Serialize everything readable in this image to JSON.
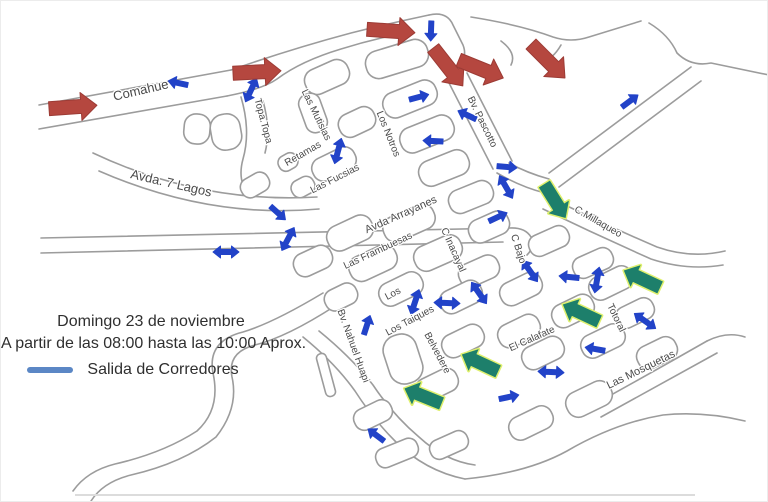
{
  "legend": {
    "date_line": "Domingo 23 de noviembre",
    "time_line": "A partir de las 08:00 hasta las 10:00 Aprox.",
    "start_label": "Salida de Corredores",
    "swatch_color": "#5b87c5"
  },
  "colors": {
    "background": "#ffffff",
    "road": "#9c9c9c",
    "street_label": "#4a4a4a",
    "route_arrow_blue": "#2243c8",
    "entry_arrow_red": "#b5473f",
    "entry_arrow_red_edge": "#9c3b35",
    "start_arrow_green": "#1d7f6b",
    "start_arrow_outline": "#dff06e"
  },
  "streets": [
    {
      "name": "Comahue",
      "x": 140,
      "y": 90,
      "rot": -13,
      "fs": 13
    },
    {
      "name": "Avda. 7 Lagos",
      "x": 170,
      "y": 183,
      "rot": 13,
      "fs": 13
    },
    {
      "name": "Topa.Topa",
      "x": 262,
      "y": 120,
      "rot": 75,
      "fs": 10
    },
    {
      "name": "Las Mutisias",
      "x": 315,
      "y": 114,
      "rot": 64,
      "fs": 10
    },
    {
      "name": "Retamas",
      "x": 302,
      "y": 153,
      "rot": -30,
      "fs": 10
    },
    {
      "name": "Las Fucsias",
      "x": 334,
      "y": 178,
      "rot": -27,
      "fs": 10
    },
    {
      "name": "Los Notros",
      "x": 387,
      "y": 133,
      "rot": 68,
      "fs": 10
    },
    {
      "name": "Bv. Pascotto",
      "x": 481,
      "y": 121,
      "rot": 64,
      "fs": 10
    },
    {
      "name": "Avda Arrayanes",
      "x": 400,
      "y": 214,
      "rot": -24,
      "fs": 11
    },
    {
      "name": "Las Frambuesas",
      "x": 377,
      "y": 250,
      "rot": -25,
      "fs": 10
    },
    {
      "name": "C Inacayal",
      "x": 452,
      "y": 249,
      "rot": 66,
      "fs": 10
    },
    {
      "name": "C Bajo",
      "x": 517,
      "y": 248,
      "rot": 72,
      "fs": 10
    },
    {
      "name": "C.Millaqueo",
      "x": 597,
      "y": 221,
      "rot": 30,
      "fs": 10
    },
    {
      "name": "Los",
      "x": 392,
      "y": 293,
      "rot": -28,
      "fs": 10
    },
    {
      "name": "Los Taiques",
      "x": 409,
      "y": 320,
      "rot": -28,
      "fs": 10
    },
    {
      "name": "Belvedere",
      "x": 436,
      "y": 352,
      "rot": 62,
      "fs": 10
    },
    {
      "name": "El Calafate",
      "x": 531,
      "y": 338,
      "rot": -24,
      "fs": 10
    },
    {
      "name": "Totoral",
      "x": 615,
      "y": 317,
      "rot": 64,
      "fs": 10
    },
    {
      "name": "Las Mosquetas",
      "x": 640,
      "y": 369,
      "rot": -26,
      "fs": 11
    },
    {
      "name": "Bv. Nahuel Huapi",
      "x": 352,
      "y": 345,
      "rot": 70,
      "fs": 10
    }
  ],
  "arrows": {
    "red": [
      {
        "x": 72,
        "y": 106,
        "rot": -4
      },
      {
        "x": 256,
        "y": 71,
        "rot": -3
      },
      {
        "x": 390,
        "y": 30,
        "rot": 4
      },
      {
        "x": 447,
        "y": 66,
        "rot": 52
      },
      {
        "x": 480,
        "y": 68,
        "rot": 22
      },
      {
        "x": 547,
        "y": 60,
        "rot": 45
      }
    ],
    "green": [
      {
        "x": 554,
        "y": 200,
        "rot": 58
      },
      {
        "x": 641,
        "y": 278,
        "rot": 205
      },
      {
        "x": 580,
        "y": 312,
        "rot": 205
      },
      {
        "x": 479,
        "y": 362,
        "rot": 205
      },
      {
        "x": 422,
        "y": 395,
        "rot": 202
      }
    ],
    "blue": [
      {
        "x": 177,
        "y": 82,
        "rot": 192
      },
      {
        "x": 250,
        "y": 89,
        "rot": 115,
        "double": true
      },
      {
        "x": 337,
        "y": 150,
        "rot": 105,
        "double": true
      },
      {
        "x": 430,
        "y": 30,
        "rot": 92
      },
      {
        "x": 629,
        "y": 100,
        "rot": -37
      },
      {
        "x": 418,
        "y": 96,
        "rot": -15
      },
      {
        "x": 466,
        "y": 114,
        "rot": 205
      },
      {
        "x": 432,
        "y": 140,
        "rot": 183
      },
      {
        "x": 506,
        "y": 166,
        "rot": 5
      },
      {
        "x": 505,
        "y": 186,
        "rot": 60,
        "double": true
      },
      {
        "x": 225,
        "y": 251,
        "rot": 0,
        "double": true
      },
      {
        "x": 277,
        "y": 212,
        "rot": 42
      },
      {
        "x": 287,
        "y": 238,
        "rot": 118,
        "double": true
      },
      {
        "x": 497,
        "y": 216,
        "rot": -25
      },
      {
        "x": 529,
        "y": 270,
        "rot": 55,
        "double": true
      },
      {
        "x": 478,
        "y": 292,
        "rot": 55,
        "double": true
      },
      {
        "x": 414,
        "y": 301,
        "rot": 108,
        "double": true
      },
      {
        "x": 446,
        "y": 302,
        "rot": 2,
        "double": true
      },
      {
        "x": 366,
        "y": 324,
        "rot": -72
      },
      {
        "x": 568,
        "y": 276,
        "rot": 186
      },
      {
        "x": 596,
        "y": 279,
        "rot": 100,
        "double": true
      },
      {
        "x": 644,
        "y": 320,
        "rot": 35,
        "double": true
      },
      {
        "x": 594,
        "y": 348,
        "rot": 190
      },
      {
        "x": 550,
        "y": 371,
        "rot": 3,
        "double": true
      },
      {
        "x": 508,
        "y": 396,
        "rot": -12
      },
      {
        "x": 375,
        "y": 434,
        "rot": 217
      }
    ]
  }
}
